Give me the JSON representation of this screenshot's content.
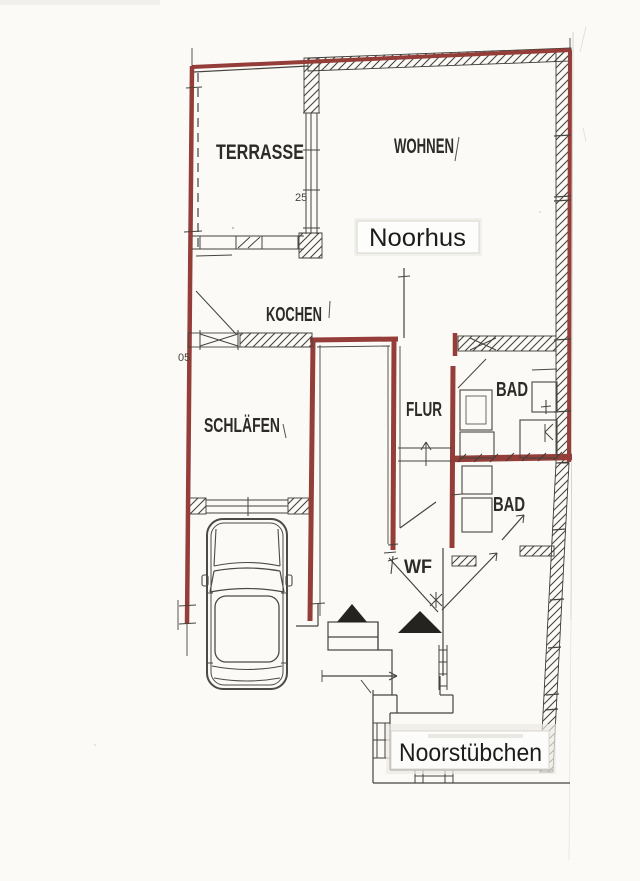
{
  "palette": {
    "paper": "#fbfaf6",
    "ink": "#3e3c37",
    "red_marker": "#943d39",
    "tag_background": "#fdfdfb",
    "tag_border": "#d8d6cf"
  },
  "floorplan": {
    "rooms": [
      {
        "id": "terrasse",
        "label": "TERRASSE"
      },
      {
        "id": "wohnen",
        "label": "WOHNEN"
      },
      {
        "id": "kochen",
        "label": "KOCHEN"
      },
      {
        "id": "schlaefen",
        "label": "SCHLÄFEN"
      },
      {
        "id": "flur",
        "label": "FLUR"
      },
      {
        "id": "bad_upper",
        "label": "BAD"
      },
      {
        "id": "bad_lower",
        "label": "BAD"
      },
      {
        "id": "wf",
        "label": "WF"
      }
    ],
    "tags": {
      "noorhus": "Noorhus",
      "noorstuebchen": "Noorstübchen"
    },
    "dimensions": {
      "door_width": "05",
      "window_width": "25"
    }
  }
}
